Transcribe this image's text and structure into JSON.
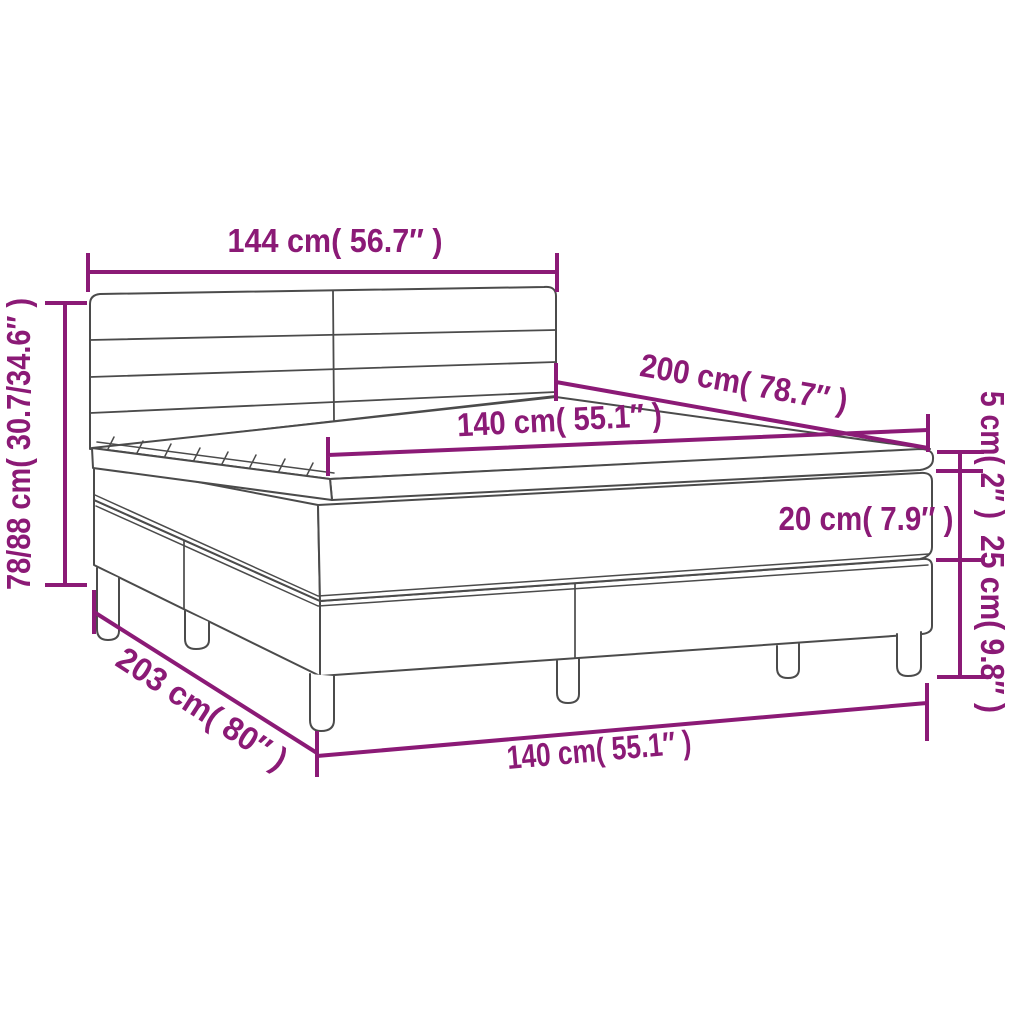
{
  "diagram": {
    "name": "box-spring-bed-dimension-diagram",
    "colors": {
      "dimension": "#8B1A76",
      "outline": "#4B4B4B",
      "background": "#FFFFFF"
    },
    "dimensions": {
      "headboard_width": {
        "cm": "144",
        "inches": "56.7",
        "label": "144 cm( 56.7″ )"
      },
      "height_range": {
        "cm": "78/88",
        "inches": "30.7/34.6",
        "label": "78/88 cm( 30.7/34.6″ )"
      },
      "bed_length": {
        "cm": "200",
        "inches": "78.7",
        "label": "200 cm( 78.7″ )"
      },
      "mattress_width": {
        "cm": "140",
        "inches": "55.1",
        "label": "140 cm( 55.1″ )"
      },
      "topper_thickness": {
        "cm": "5",
        "inches": "2",
        "label": "5 cm( 2″ )"
      },
      "mattress_thickness": {
        "cm": "20",
        "inches": "7.9",
        "label": "20 cm( 7.9″ )"
      },
      "base_leg_height": {
        "cm": "25",
        "inches": "9.8",
        "label": "25 cm( 9.8″ )"
      },
      "frame_length": {
        "cm": "203",
        "inches": "80",
        "label": "203 cm( 80″ )"
      },
      "base_width": {
        "cm": "140",
        "inches": "55.1",
        "label": "140 cm( 55.1″ )"
      }
    }
  }
}
